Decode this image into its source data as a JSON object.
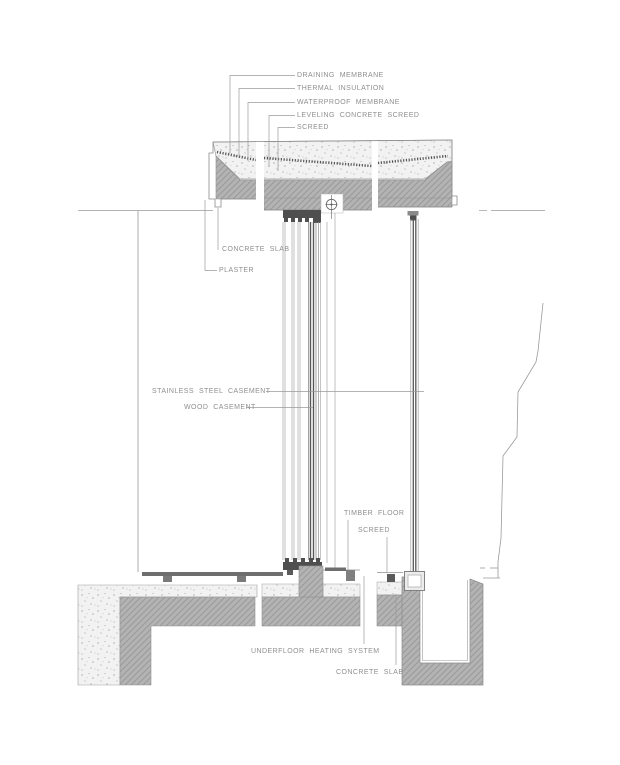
{
  "drawing": {
    "kind": "architectural construction detail section",
    "labels": {
      "draining_membrane": "DRAINING MEMBRANE",
      "thermal_insulation": "THERMAL INSULATION",
      "waterproof_membrane": "WATERPROOF MEMBRANE",
      "leveling_concrete_screed": "LEVELING CONCRETE SCREED",
      "screed_roof": "SCREED",
      "concrete_slab_roof": "CONCRETE SLAB",
      "plaster": "PLASTER",
      "stainless_steel_casement": "STAINLESS STEEL CASEMENT",
      "wood_casement": "WOOD CASEMENT",
      "timber_floor": "TIMBER FLOOR",
      "screed_floor": "SCREED",
      "underfloor_heating_system": "UNDERFLOOR HEATING SYSTEM",
      "concrete_slab_floor": "CONCRETE SLAB"
    },
    "colors": {
      "background": "#ffffff",
      "line": "#8f8f8f",
      "leader_line": "#9a9a9a",
      "text": "#8f8f8f",
      "slab_fill": "#b3b3b3",
      "hatch_line": "#949494",
      "stipple_background": "#f2f2f2",
      "stipple_dot": "#8a8a8a",
      "dark_profile": "#4f4f4f",
      "membrane_dots": "#3c3c3c"
    }
  }
}
